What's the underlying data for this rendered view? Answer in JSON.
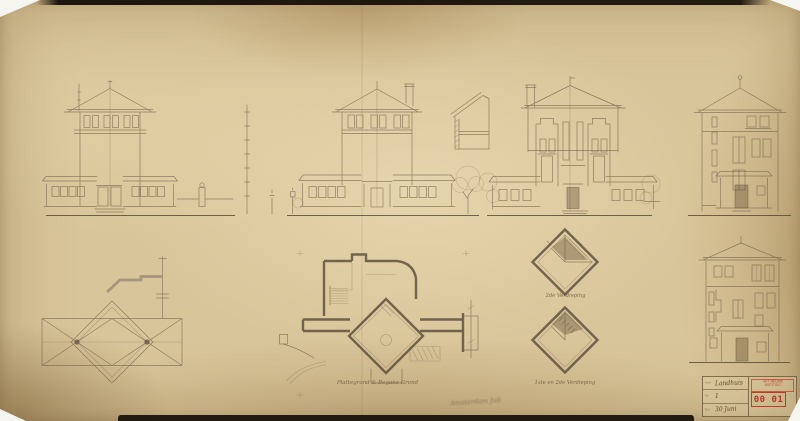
{
  "artwork": {
    "captions": {
      "ground_floor_plan": "Plattegrond & Begane Grond",
      "upper_floor_plan": "2de Verdieping",
      "middle_floors_plan": "1ste en 2de Verdieping",
      "signature": "Amsterdam Juli"
    },
    "stamp": {
      "rows": [
        {
          "label": "Arch",
          "value": "Landhuis"
        },
        {
          "label": "No",
          "value": "1"
        },
        {
          "label": "Dat",
          "value": "30 Juni"
        }
      ],
      "archive_stamp_line1": "HET NIEUWE",
      "archive_stamp_line2": "INSTITUUT",
      "inventory_number": "00 01"
    },
    "colors": {
      "paper": "#d9c59a",
      "ink": "#6f5f49",
      "stamp_red": "#b5402e"
    }
  }
}
